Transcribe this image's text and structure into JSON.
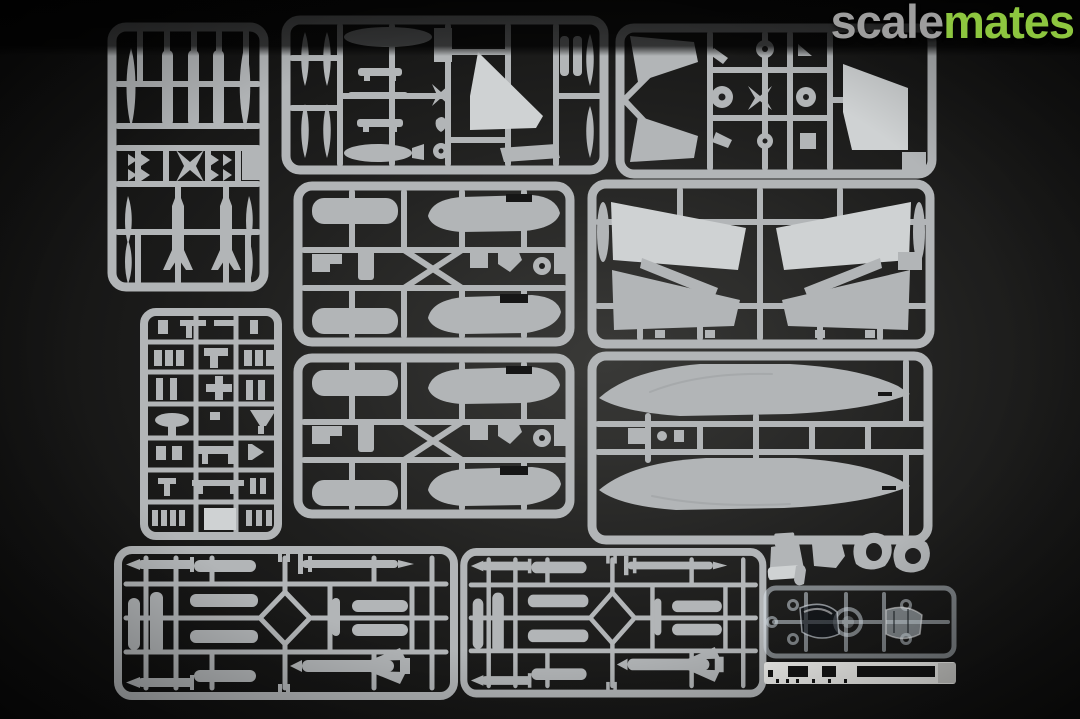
{
  "image": {
    "kind": "photograph",
    "description": "Top-down photo of light-grey injection-moulded sprues of a jet aircraft plastic model kit laid out on a dark backdrop, with clear canopy sprue and white decal strip at lower right"
  },
  "watermark": {
    "text_gray": "scale",
    "text_green": "mates"
  },
  "colors": {
    "wm_gray": "#9d9d9d",
    "wm_green": "#8dc63f",
    "plastic": "#b2b5b7",
    "plastic_bright": "#cfd2d3",
    "plastic_dim": "#9a9da0",
    "backdrop_center": "#3a3a38",
    "backdrop_mid": "#1f1f1e",
    "backdrop_edge": "#070707",
    "clear_stroke": "rgba(222,232,240,0.5)",
    "decal_white": "#efefec",
    "decal_black": "#141414"
  },
  "items": [
    {
      "name": "sprue-drop-tanks-missiles",
      "label": "sprue with drop tank halves and two large missiles"
    },
    {
      "name": "sprue-small-parts-and-tail-fin",
      "label": "sprue with pylons, tank halves and vertical tail fin"
    },
    {
      "name": "sprue-tailplanes-wheels-fin",
      "label": "sprue with tailplanes, wheels, landing gear and swept fin"
    },
    {
      "name": "sprue-detail-parts",
      "label": "sprue with small detail and landing-gear parts"
    },
    {
      "name": "sprue-fuselage-deck-1",
      "label": "sprue with fuselage deck halves and inserts"
    },
    {
      "name": "sprue-fuselage-deck-2",
      "label": "identical second fuselage deck sprue"
    },
    {
      "name": "sprue-wing-halves",
      "label": "sprue with four wing halves"
    },
    {
      "name": "sprue-fuselage-halves",
      "label": "sprue with two long fuselage halves"
    },
    {
      "name": "sprue-weapons-1",
      "label": "weapons sprue with bombs, missiles and rocket pods"
    },
    {
      "name": "sprue-weapons-2",
      "label": "identical second weapons sprue"
    },
    {
      "name": "loose-parts",
      "label": "ejection seat, seat back and two exhaust nozzle parts"
    },
    {
      "name": "clear-canopy-sprue",
      "label": "transparent sprue with canopy and windshield"
    },
    {
      "name": "decal-strip",
      "label": "white decal / film strip with black markings"
    }
  ]
}
